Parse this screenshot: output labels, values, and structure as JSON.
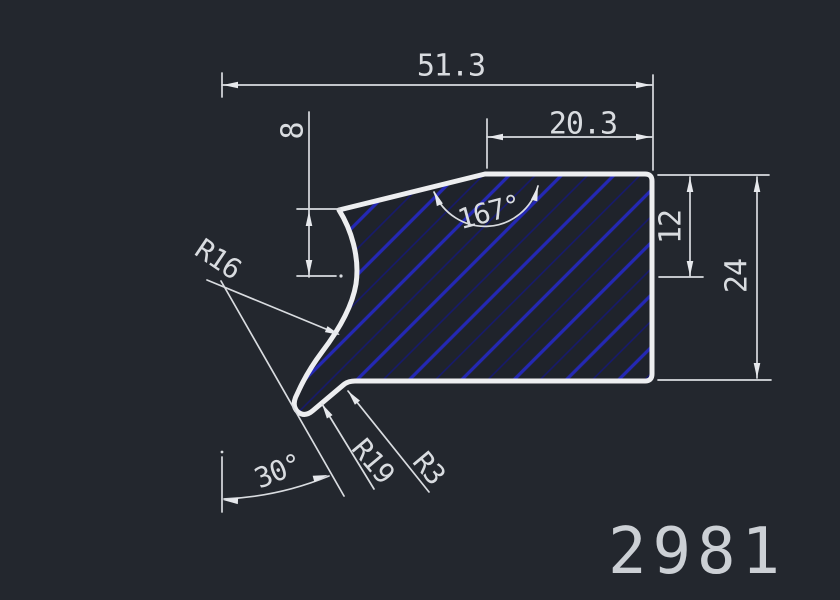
{
  "drawing": {
    "part_number": "2981",
    "labels": {
      "total_width": "51.3",
      "upper_width": "20.3",
      "left_drop": "8",
      "top_angle": "167°",
      "right_upper_height": "12",
      "total_height": "24",
      "radius_main": "R16",
      "radius_lip": "R19",
      "radius_fillet": "R3",
      "lip_angle": "30°"
    },
    "colors": {
      "background": "#23272e",
      "profile_outline": "#edeef0",
      "annotation": "#d9dce0",
      "hatch_bold": "#2428b4",
      "hatch_fine": "#161970"
    }
  }
}
